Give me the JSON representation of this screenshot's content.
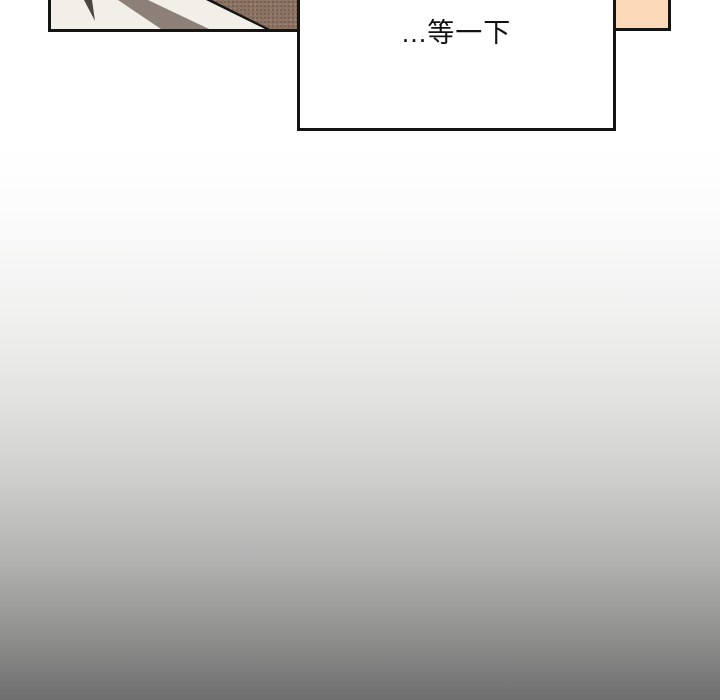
{
  "page": {
    "width": 720,
    "height": 700,
    "gradient_top_color": "#ffffff",
    "gradient_bottom_color": "#6e6e6e"
  },
  "comic": {
    "left_panel": {
      "bg_color": "#f2efe8",
      "sliver_color": "#4c463f",
      "stripe_color": "#8d8078",
      "diagonal_edge_color": "#141414",
      "texture_color": "#8a7365",
      "border_color": "#141414"
    },
    "speech_box": {
      "text": "...等一下",
      "bg_color": "#ffffff",
      "text_color": "#121212",
      "border_color": "#141414"
    },
    "corner_panel": {
      "bg_color": "#fcd9b8",
      "border_color": "#141414"
    }
  }
}
